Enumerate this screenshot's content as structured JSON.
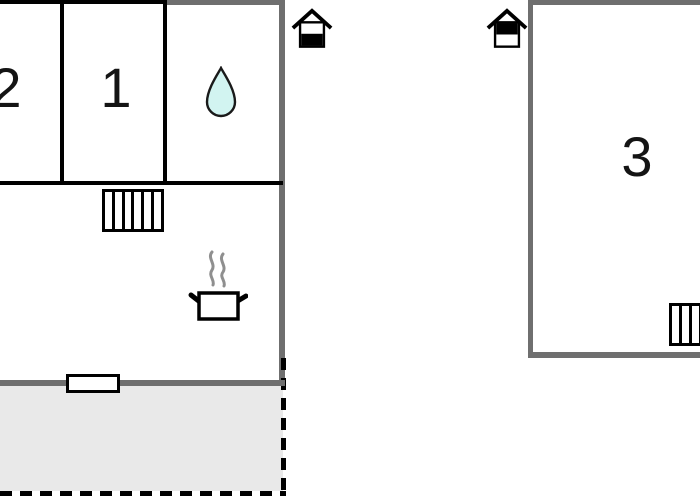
{
  "floorplan": {
    "kind": "holiday-home floor plan, two buildings, cropped at left/top/right edges",
    "left_building": {
      "rooms": [
        {
          "label": "2"
        },
        {
          "label": "1"
        }
      ],
      "icons": {
        "bathroom": "water-drop-icon",
        "kitchen": "cooking-pot-with-steam-icon",
        "stairs": "stairs-icon",
        "door": "door-window-marker"
      },
      "terrace": {
        "name": "terrace",
        "fill": "#e9e9e9",
        "border_style": "dashed"
      }
    },
    "right_building": {
      "rooms": [
        {
          "label": "3"
        }
      ],
      "icons": {
        "stairs": "stairs-icon"
      }
    },
    "site_icons": [
      {
        "name": "entrance-house-icon",
        "variant": "door-bottom-filled"
      },
      {
        "name": "entrance-house-icon",
        "variant": "door-top-filled"
      }
    ],
    "colors": {
      "exterior_wall": "#6f6f6f",
      "interior_wall": "#000000",
      "terrace_fill": "#e9e9e9",
      "water_drop_fill": "#d2f4f1",
      "steam": "#8f8f8f",
      "label_text": "#141414",
      "background": "#ffffff"
    }
  }
}
